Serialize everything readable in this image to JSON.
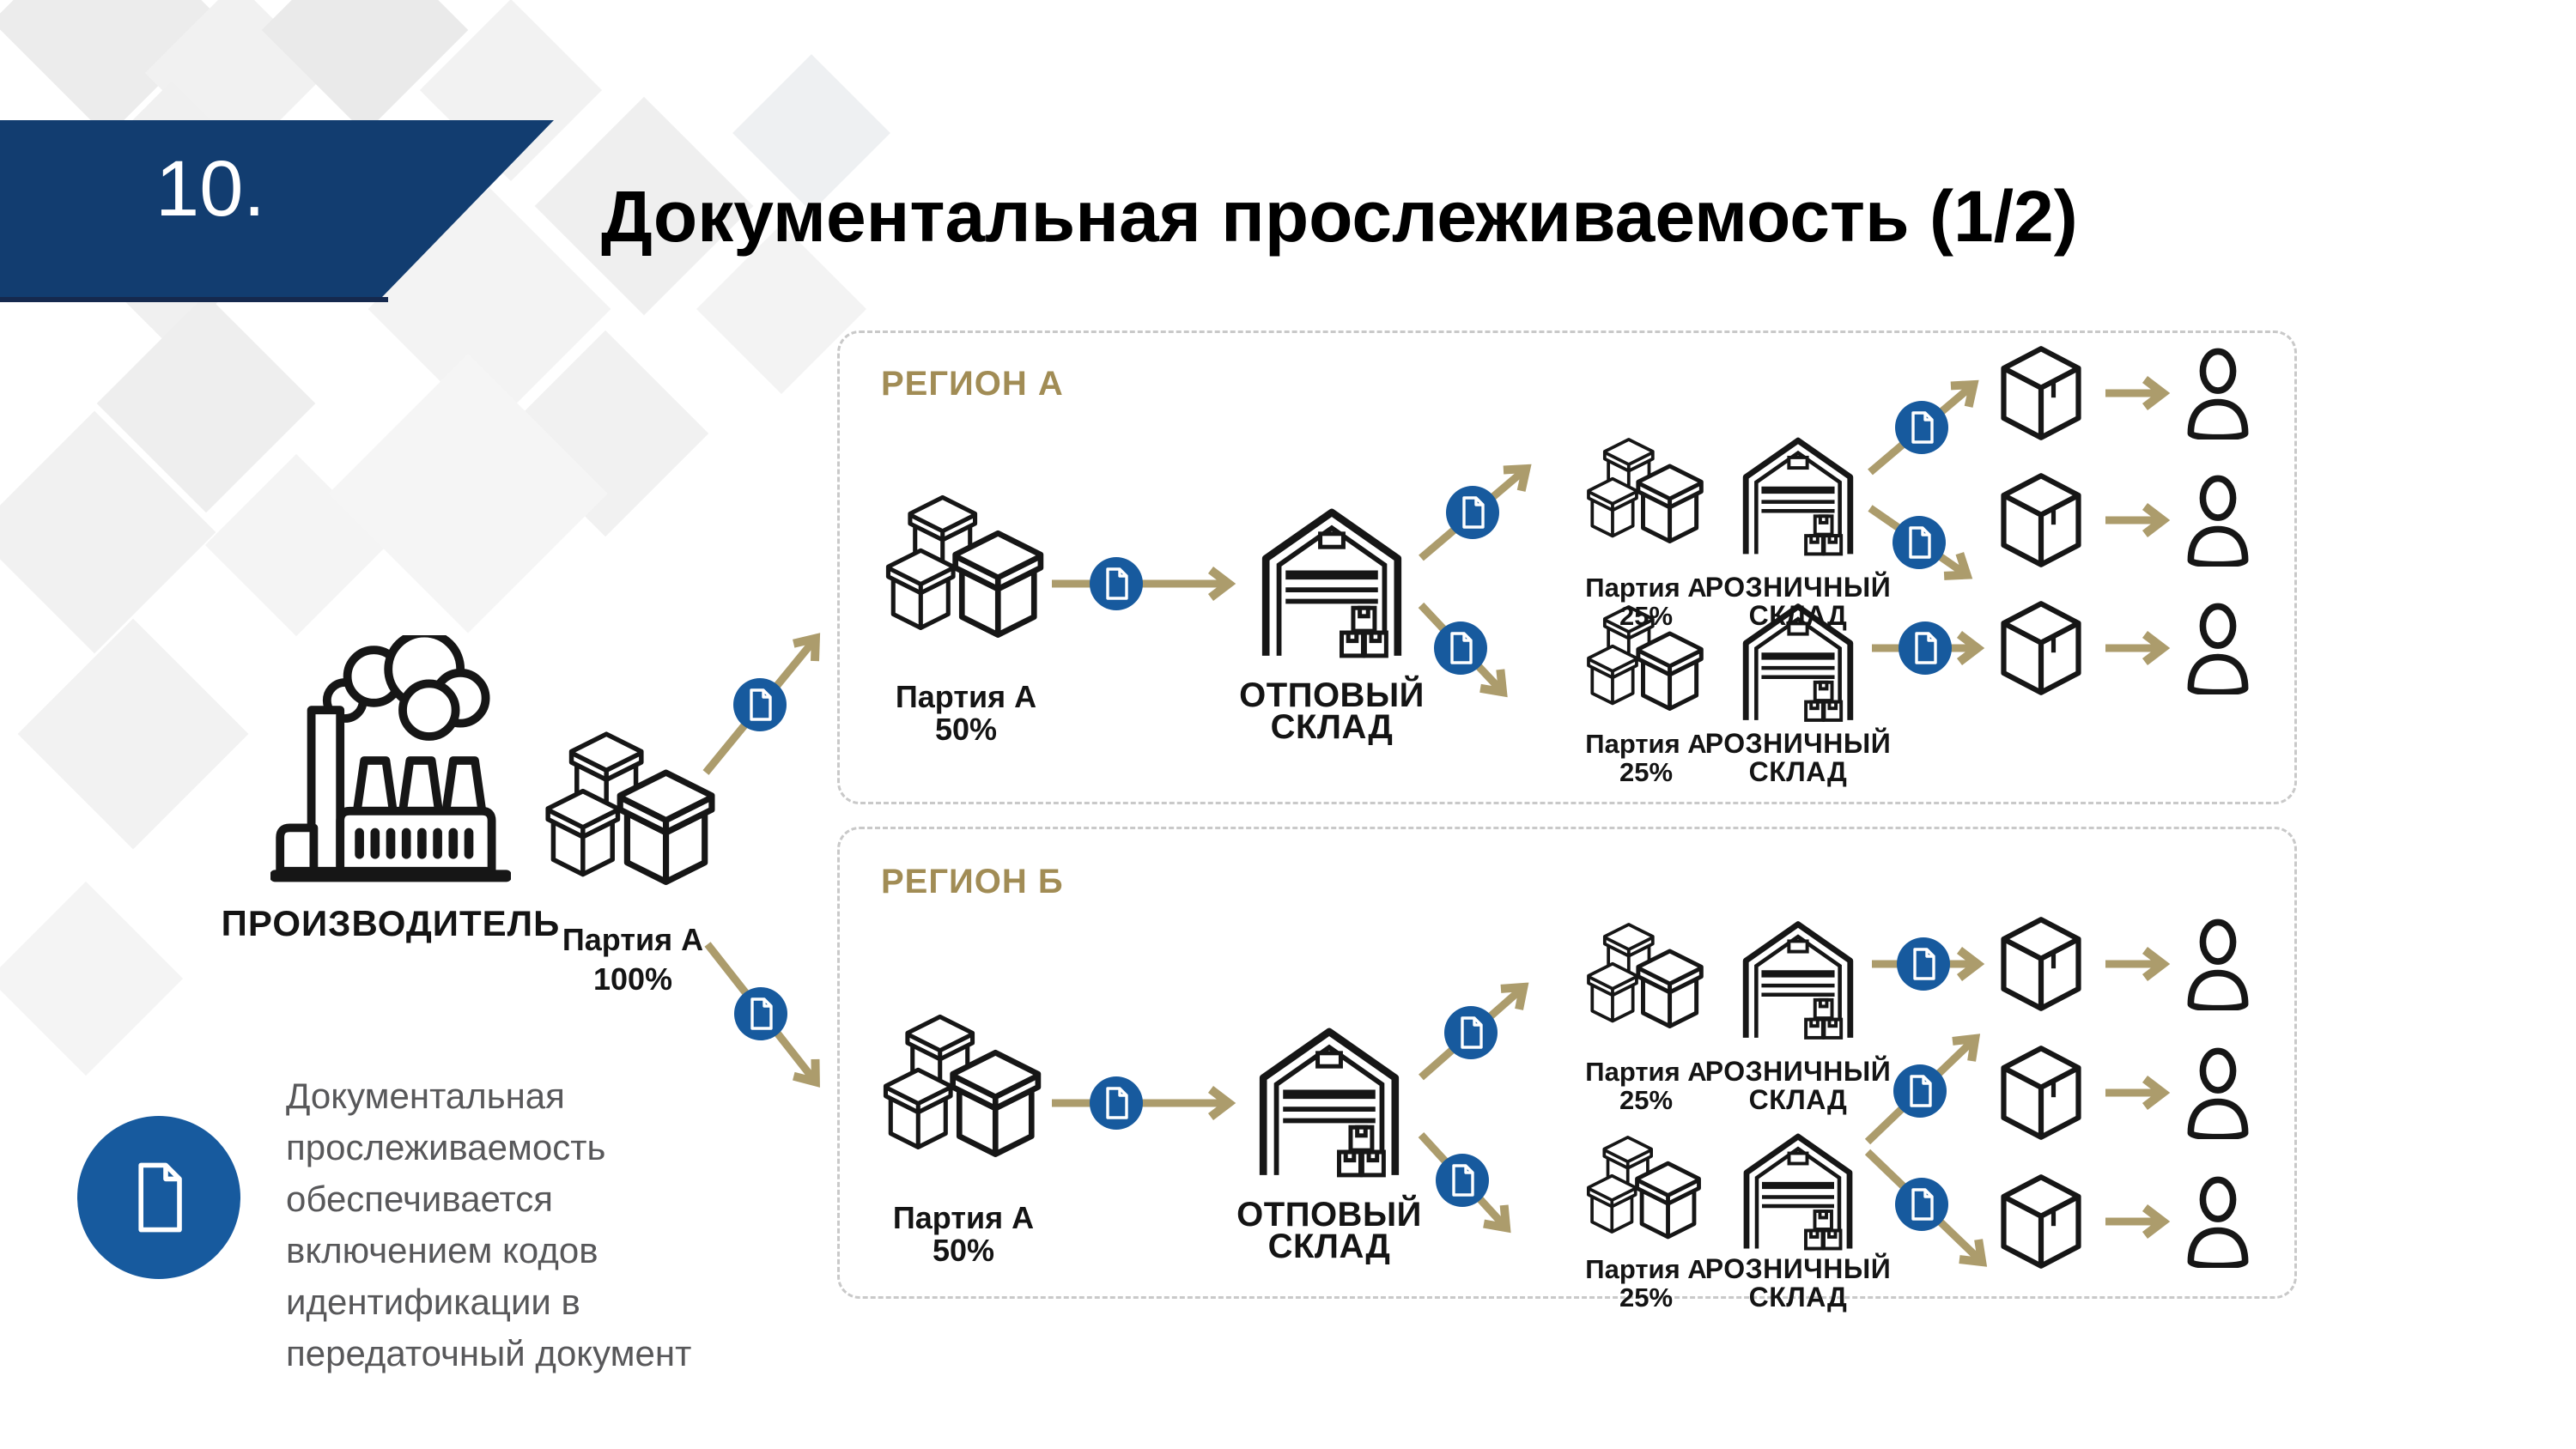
{
  "slide": {
    "number": "10.",
    "title": "Документальная прослеживаемость (1/2)"
  },
  "manufacturer": {
    "label": "ПРОИЗВОДИТЕЛЬ",
    "batch": "Партия А\n100%"
  },
  "regions": {
    "a": {
      "name": "РЕГИОН А",
      "batch50": "Партия А\n50%",
      "wholesale": "ОТПОВЫЙ\nСКЛАД",
      "batch25_top": "Партия А\n25%",
      "retail_top": "РОЗНИЧНЫЙ\nСКЛАД",
      "batch25_bottom": "Партия А\n25%",
      "retail_bottom": "РОЗНИЧНЫЙ\nСКЛАД"
    },
    "b": {
      "name": "РЕГИОН Б",
      "batch50": "Партия А\n50%",
      "wholesale": "ОТПОВЫЙ\nСКЛАД",
      "batch25_top": "Партия А\n25%",
      "retail_top": "РОЗНИЧНЫЙ\nСКЛАД",
      "batch25_bottom": "Партия А\n25%",
      "retail_bottom": "РОЗНИЧНЫЙ\nСКЛАД"
    }
  },
  "note": {
    "text": "Документальная\nпрослеживаемость\nобеспечивается\nвключением кодов\nидентификации в\nпередаточный документ"
  },
  "icons": {
    "document": "document-icon",
    "factory": "factory-icon",
    "boxes": "batch-boxes-icon",
    "warehouse": "warehouse-icon",
    "package": "package-icon",
    "person": "person-icon"
  },
  "colors": {
    "banner_blue": "#123D70",
    "accent_blue": "#175A9E",
    "gold_arrow": "#AC9C6C",
    "gold_label": "#A18C55",
    "text_gray": "#58585A",
    "border_gray": "#C9C9C9",
    "icon_black": "#161616"
  }
}
